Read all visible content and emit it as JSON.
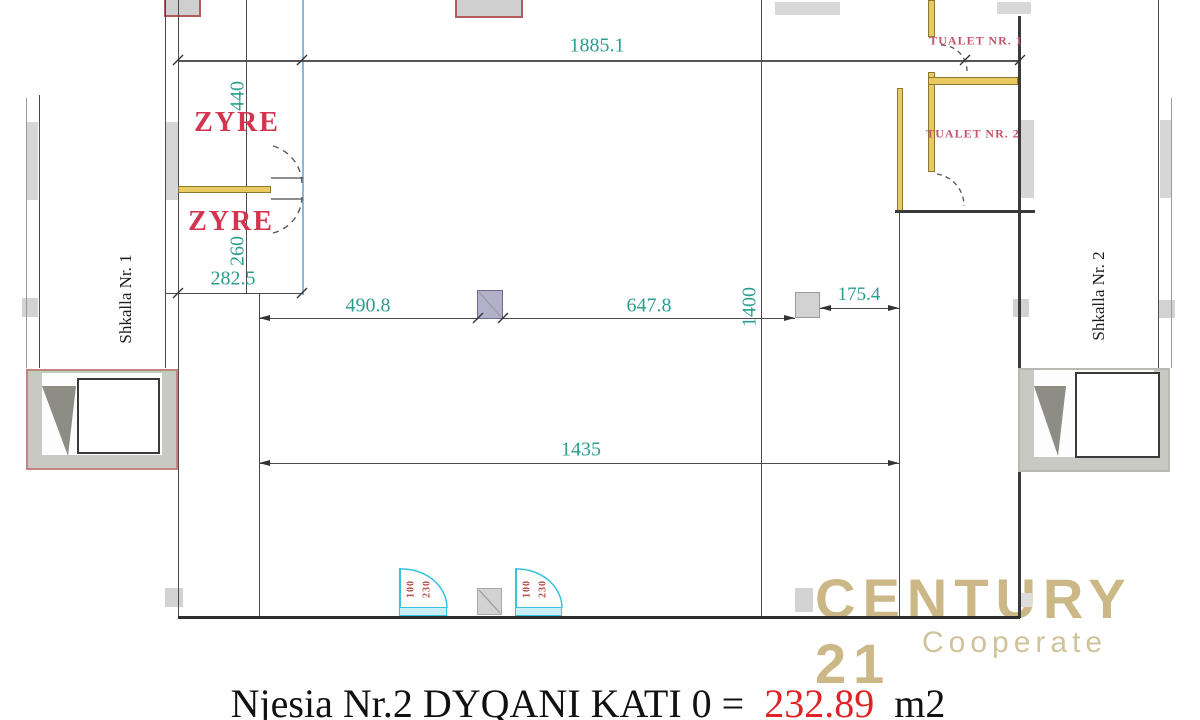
{
  "labels": {
    "zyre_1": "ZYRE",
    "zyre_2": "ZYRE",
    "tualet_1": "TUALET NR. 1",
    "tualet_2": "TUALET NR. 2",
    "shkalla_1": "Shkalla Nr. 1",
    "shkalla_2": "Shkalla Nr. 2"
  },
  "dimensions": {
    "top_total": "1885.1",
    "zyre1_height": "440",
    "zyre2_height": "260",
    "zyre_width": "282.5",
    "span_left": "490.8",
    "span_right": "647.8",
    "depth": "1400",
    "offset_right": "175.4",
    "span_lower": "1435"
  },
  "doors": {
    "door_1": {
      "width": "100",
      "height": "230"
    },
    "door_2": {
      "width": "100",
      "height": "230"
    }
  },
  "watermark": {
    "brand": "CENTURY 21",
    "tagline": "Cooperate"
  },
  "caption": {
    "unit_label": "Njesia Nr.2 DYQANI KATI 0 =",
    "area_value": "232.89",
    "area_unit": "m2"
  },
  "colors": {
    "dimension_text": "#2a9d8f",
    "room_label": "#d3344f",
    "toilet_label": "#c4556b",
    "door_dim_label": "#b5524e",
    "wall_line": "#4a4a4a",
    "wall_yellow": "#eac963",
    "partition_blue": "#8ab8d8",
    "door_cyan": "#35c3dd",
    "fill_gray": "#d2d2d2",
    "stair_border_pink": "#c28484",
    "column_red_border": "#b25b5b",
    "watermark_gold": "#c8b27c",
    "area_red": "#e02424"
  }
}
